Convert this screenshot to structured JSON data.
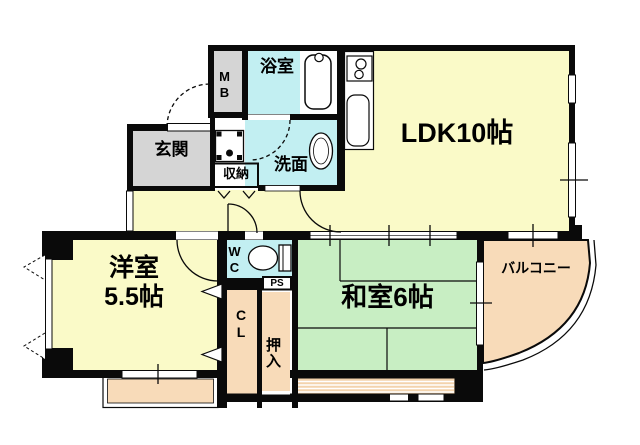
{
  "palette": {
    "wall": "#0a0a0a",
    "room_yellow": "#FAFAC8",
    "water_cyan": "#C2EFF2",
    "tatami_green": "#C8EEC3",
    "balcony_peach": "#F8DBB9",
    "deck_peach": "#F3D3AC",
    "entry_gray": "#D5D5D5",
    "storage_cream": "#F6E5BE",
    "white": "#FFFFFF"
  },
  "rooms": {
    "ldk": {
      "label": "LDK10帖"
    },
    "washitsu": {
      "label": "和室6帖"
    },
    "youshitsu": {
      "label": "洋室",
      "size": "5.5帖"
    },
    "genkan": {
      "label": "玄関"
    },
    "bathroom": {
      "label": "浴室"
    },
    "washroom": {
      "label": "洗面"
    },
    "storage": {
      "label": "収納"
    },
    "meter_box": {
      "label": "MB"
    },
    "toilet": {
      "label": "WC"
    },
    "pipe_space": {
      "label": "PS"
    },
    "closet": {
      "label": "CL"
    },
    "oshiire": {
      "label": "押入"
    },
    "balcony": {
      "label": "バルコニー"
    }
  }
}
